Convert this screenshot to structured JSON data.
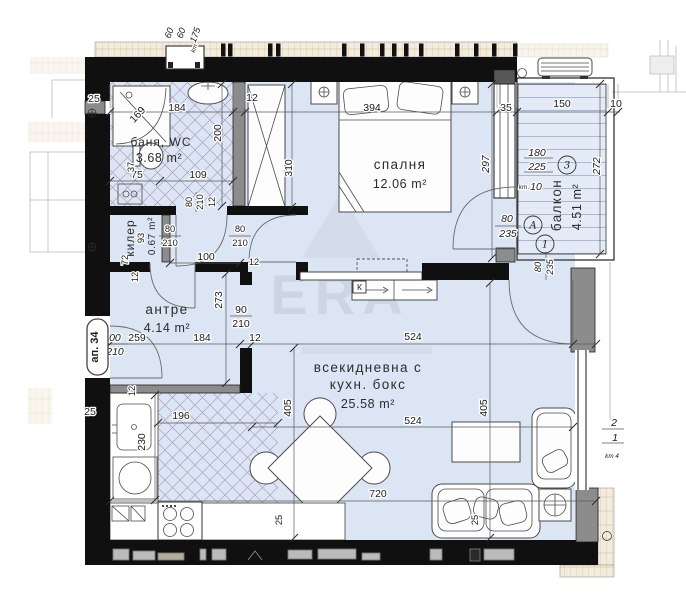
{
  "watermark": {
    "text": "ERA"
  },
  "badge": {
    "apartment": "ап. 34"
  },
  "rooms": {
    "bath": {
      "name": "баня, WC",
      "area": "3.68 m²"
    },
    "bedroom": {
      "name": "спалня",
      "area": "12.06 m²"
    },
    "balcony": {
      "name": "балкон",
      "area": "4.51 m²"
    },
    "closet": {
      "name": "килер",
      "area": "0.67 m²"
    },
    "hall": {
      "name": "антре",
      "area": "4.14 m²"
    },
    "living": {
      "name1": "всекидневна с",
      "name2": "кухн. бокс",
      "area": "25.58 m²"
    }
  },
  "markers": {
    "window_circle": "3",
    "door_circle_a": "А",
    "door_circle_1": "1",
    "kitchen_box": "К"
  },
  "level": {
    "top": "2",
    "bottom": "1",
    "unit": "km 4"
  },
  "dims": {
    "top": {
      "a": "60",
      "b": "60",
      "c": "175",
      "km": "km"
    },
    "bath": {
      "width": "184",
      "shower": "169",
      "depth": "200",
      "left": "75",
      "right": "109",
      "small": "37",
      "door_w": "80",
      "door_h": "210",
      "door_wall": "12",
      "wall": "12",
      "thk": "25"
    },
    "bedroom": {
      "bed": "394",
      "height": "297",
      "wardrobe": "310",
      "window": "35"
    },
    "balcony": {
      "width": "150",
      "edge": "10",
      "w1": "180",
      "w2": "225",
      "km": "km",
      "parapet": "10",
      "height": "272",
      "door_w": "80",
      "door_h": "235",
      "adoor_w": "80",
      "adoor_h": "235"
    },
    "closet": {
      "d93": "93",
      "d72": "72",
      "wall": "12",
      "door_w": "80",
      "door_h": "210"
    },
    "hall": {
      "height": "273",
      "corridor": "100",
      "bdoor_w": "80",
      "bdoor_h": "210",
      "ldoor_w": "90",
      "ldoor_h": "210",
      "ent_w": "100",
      "ent_h": "210",
      "w1": "259",
      "w2": "184",
      "wall": "12",
      "wall2": "12",
      "thk": "25"
    },
    "living": {
      "top": "524",
      "mid": "524",
      "left": "405",
      "right": "405",
      "bottom": "720",
      "off1": "25",
      "off2": "25",
      "kw": "196",
      "kh": "230",
      "wall": "12"
    }
  }
}
